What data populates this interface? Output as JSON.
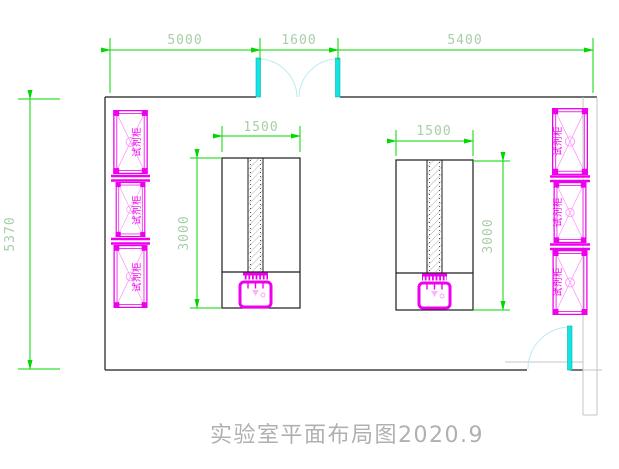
{
  "drawing": {
    "title": "实验室平面布局图2020.9",
    "cabinet_label": "试剂柜",
    "dims": {
      "top": [
        "5000",
        "1600",
        "5400"
      ],
      "left_height": "5370",
      "bench1": {
        "width": "1500",
        "depth": "3000"
      },
      "bench2": {
        "width": "1500",
        "depth": "3000"
      }
    },
    "colors": {
      "dimension_line": "#00d800",
      "dimension_text": "#a8cea8",
      "cabinet": "#ee00ee",
      "cabinet_detail": "#ff8cff",
      "door_leaf": "#17e3e3",
      "door_swing_arc": "#bce9f2",
      "wall": "#1c1c1c",
      "secondary_wall": "#c4c4c4",
      "title_text": "#b0b0b0"
    }
  }
}
